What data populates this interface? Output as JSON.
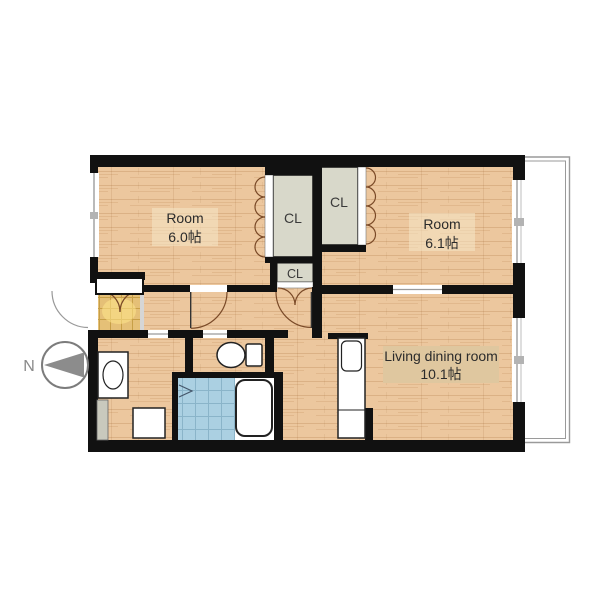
{
  "rooms": [
    {
      "label": "Room",
      "area": "6.0帖"
    },
    {
      "label": "Room",
      "area": "6.1帖"
    },
    {
      "label": "Living dining room",
      "area": "10.1帖"
    }
  ],
  "closets": [
    {
      "label": "CL"
    },
    {
      "label": "CL"
    },
    {
      "label": "CL"
    }
  ],
  "compass": {
    "north_label": "N"
  },
  "colors": {
    "wall": "#111111",
    "wood_floor": "#ecc79e",
    "closet_fill": "#d8d8ca",
    "entrance_tile": "#e5c077",
    "bath_tile": "#abd0e2",
    "balcony_line": "#9a9a9a",
    "door_arc": "#7a4a28"
  }
}
